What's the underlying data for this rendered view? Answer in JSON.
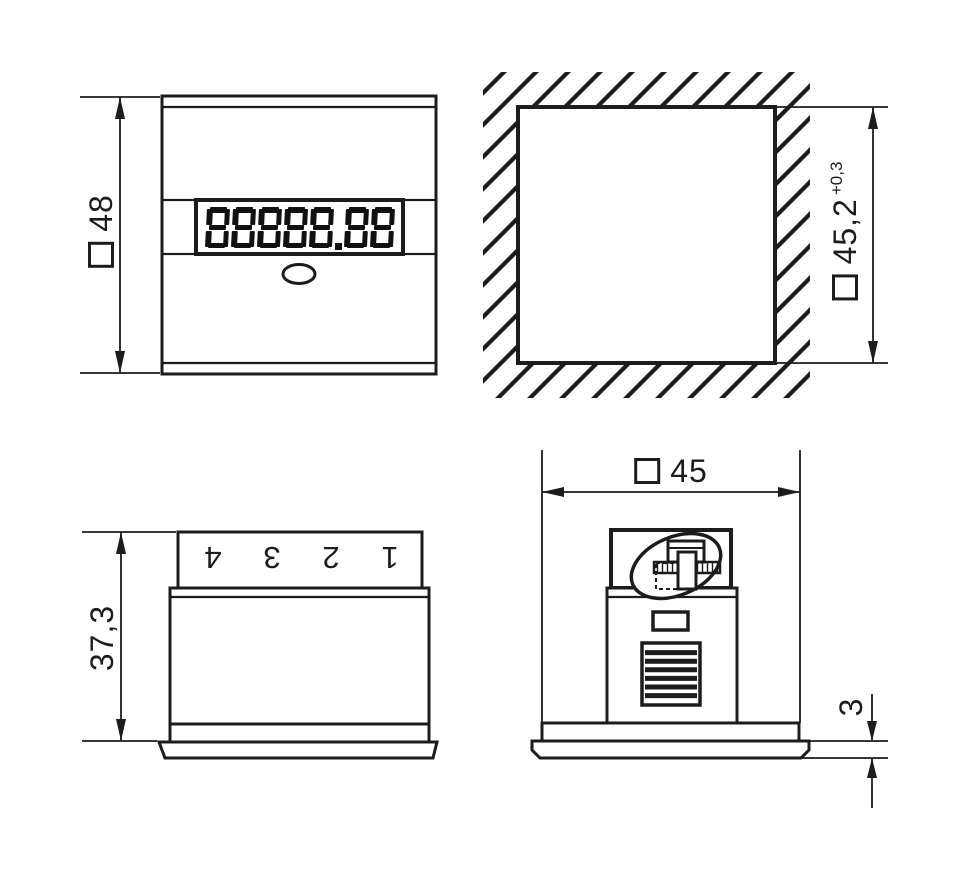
{
  "front_view": {
    "display_value": "88888.88",
    "height_dimension": {
      "symbol": "□",
      "value": "48"
    }
  },
  "panel_cutout_view": {
    "size_dimension": {
      "symbol": "□",
      "value": "45,2",
      "tolerance": "+0,3"
    }
  },
  "side_view": {
    "terminal_labels": [
      "4",
      "3",
      "2",
      "1"
    ],
    "height_dimension": {
      "value": "37,3"
    }
  },
  "rear_view": {
    "width_dimension": {
      "symbol": "□",
      "value": "45"
    },
    "bezel_thickness_dimension": {
      "value": "3"
    }
  },
  "colors": {
    "line": "#1c1c1c",
    "background": "#ffffff"
  }
}
